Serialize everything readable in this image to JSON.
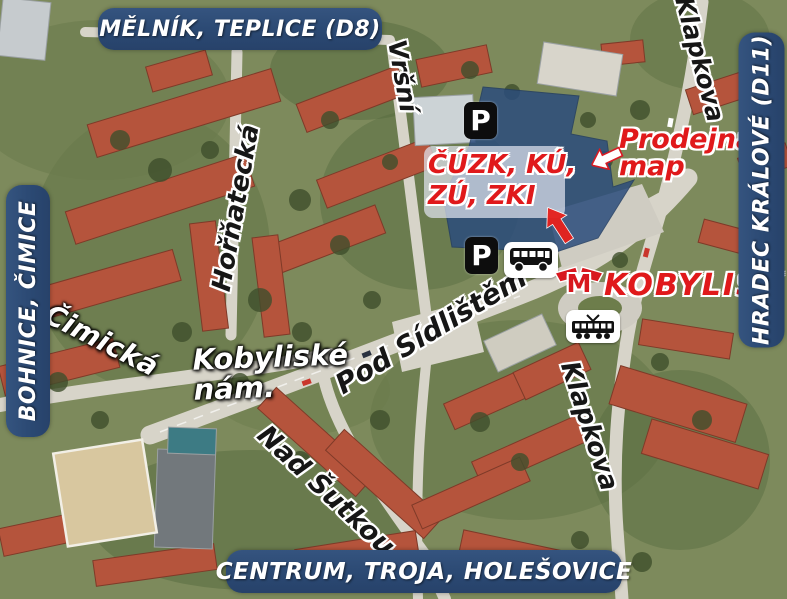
{
  "banners": {
    "top": "MĚLNÍK, TEPLICE (D8)",
    "left": "BOHNICE, ČIMICE",
    "right": "HRADEC KRÁLOVÉ (D11)",
    "bottom": "CENTRUM, TROJA, HOLEŠOVICE"
  },
  "streets": {
    "virsni": "Vršní",
    "hornatecka": "Hořňatecká",
    "klapkova_top": "Klapkova",
    "klapkova_bottom": "Klapkova",
    "cimicka": "Čimická",
    "kobyliske_nam_line1": "Kobyliské",
    "kobyliske_nam_line2": "nám.",
    "pod_sidlistem": "Pod Sídlištěm",
    "nad_sutkou": "Nad Šutkou"
  },
  "offices": {
    "line1": "ČÚZK, KÚ,",
    "line2": "ZÚ, ZKI"
  },
  "map_shop": {
    "line1": "Prodejna",
    "line2": "map"
  },
  "metro_station_name": "KOBYLISY",
  "icons": {
    "parking_label": "P",
    "metro_letter": "M",
    "bus_icon": "bus pictogram",
    "tram_icon": "tram pictogram",
    "red_arrow": "arrow pointing to office building",
    "white_arrow": "arrow pointing to map shop entrance"
  },
  "colors": {
    "banner_blue": "#2b4973",
    "label_red": "#e0191b",
    "building_highlight": "#2b4c7c"
  }
}
